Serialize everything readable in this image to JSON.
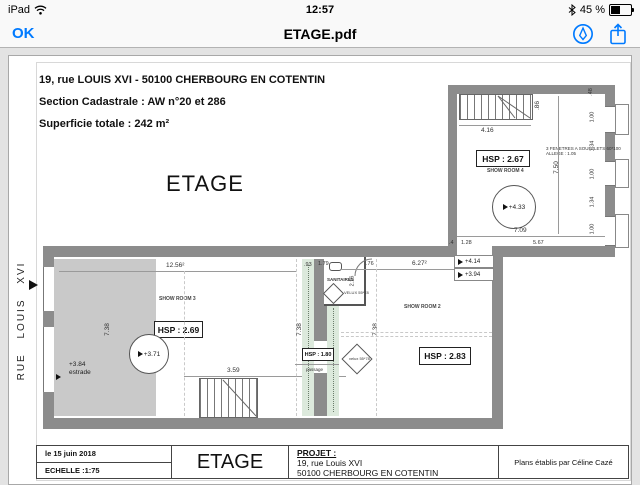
{
  "status": {
    "device": "iPad",
    "time": "12:57",
    "battery_pct": "45 %"
  },
  "toolbar": {
    "ok": "OK",
    "title": "ETAGE.pdf"
  },
  "doc": {
    "addr": "19, rue LOUIS XVI  - 50100 CHERBOURG EN COTENTIN",
    "cadastre": "Section Cadastrale : AW n°20 et 286",
    "area": "Superficie totale : 242 m²",
    "floor": "ETAGE",
    "street": "RUE LOUIS XVI"
  },
  "plan": {
    "annex": {
      "hsp": "HSP : 2.67",
      "room": "SHOW ROOM 4",
      "level": "+4.33",
      "note1": "3 FENETRES A SOUFFLETS 60*100",
      "note2": "ALLEGE : 1.05",
      "w": "7.09",
      "h": "7.50",
      "stair_w": "4.16",
      "stair_h": ".86",
      "d1": ".4",
      "d2": "1.28",
      "d3": "5.67",
      "right_dims": [
        ".48",
        "1.00",
        "1.34",
        "1.00",
        "1.34",
        "1.00"
      ]
    },
    "main": {
      "hsp": "HSP : 2.69",
      "room": "SHOW ROOM 3",
      "level": "+3.71",
      "w": "12.56²",
      "h": "7.38",
      "estrade_level": "+3.84",
      "estrade": "estrade",
      "stair": "3.59"
    },
    "mid": {
      "w_top": ".93",
      "san": "SANITAIRES",
      "san_w": "1.79",
      "san_h": "2.16",
      "san_d": ".76",
      "velux": "VELUX 55*78",
      "hsp": "HSP : 1.80",
      "passage": "passage",
      "h": "7.38"
    },
    "right": {
      "hsp": "HSP : 2.83",
      "room": "SHOW ROOM 2",
      "w": "6.27²",
      "h": "7.38",
      "lvl1": "+4.14",
      "lvl2": "+3.94",
      "velux": "velux 55*78"
    }
  },
  "tb": {
    "date": "le 15 juin 2018",
    "scale": "ECHELLE :1:75",
    "floor": "ETAGE",
    "proj": "PROJET :",
    "proj1": "19, rue Louis XVI",
    "proj2": "50100 CHERBOURG EN COTENTIN",
    "credit": "Plans établis par Céline Cazé"
  }
}
